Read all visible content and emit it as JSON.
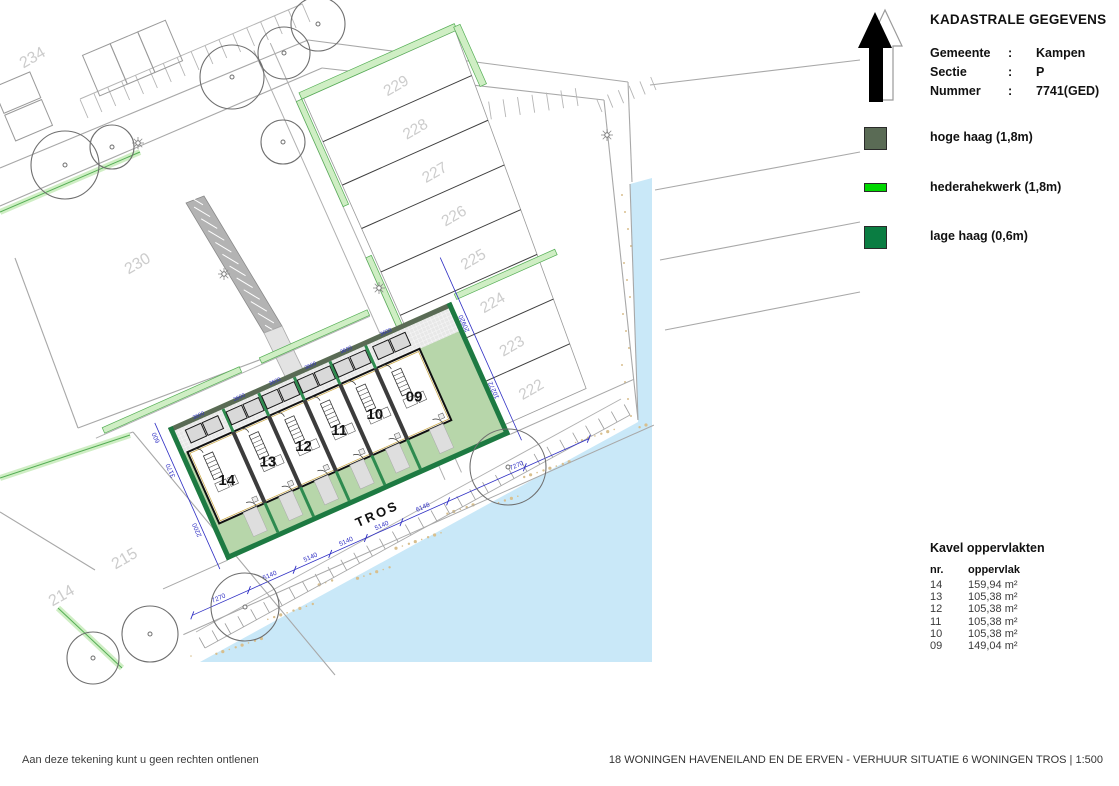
{
  "header": {
    "title": "KADASTRALE GEGEVENS",
    "rows": [
      {
        "label": "Gemeente",
        "sep": ":",
        "value": "Kampen"
      },
      {
        "label": "Sectie",
        "sep": ":",
        "value": "P"
      },
      {
        "label": "Nummer",
        "sep": ":",
        "value": "7741(GED)"
      }
    ]
  },
  "legend": {
    "items": [
      {
        "label": "hoge haag (1,8m)",
        "color": "#5a6b55",
        "h": 23
      },
      {
        "label": "hederahekwerk (1,8m)",
        "color": "#00d800",
        "h": 9
      },
      {
        "label": "lage haag  (0,6m)",
        "color": "#0a7d42",
        "h": 23
      }
    ]
  },
  "kavel": {
    "title": "Kavel oppervlakten",
    "col_nr": "nr.",
    "col_opp": "oppervlak",
    "rows": [
      [
        "14",
        "159,94 m²"
      ],
      [
        "13",
        "105,38 m²"
      ],
      [
        "12",
        "105,38 m²"
      ],
      [
        "11",
        "105,38 m²"
      ],
      [
        "10",
        "105,38 m²"
      ],
      [
        "09",
        "149,04 m²"
      ]
    ]
  },
  "footer": {
    "left": "Aan deze tekening kunt u geen rechten ontlenen",
    "right": "18 WONINGEN HAVENEILAND EN DE ERVEN - VERHUUR SITUATIE 6 WONINGEN TROS  |  1:500"
  },
  "plan": {
    "street": "TROS",
    "houses": [
      "14",
      "13",
      "12",
      "11",
      "10",
      "09"
    ],
    "strip_parcels": [
      "229",
      "228",
      "227",
      "226",
      "225",
      "224",
      "223",
      "222"
    ],
    "other_parcels": [
      [
        "234",
        35,
        62
      ],
      [
        "230",
        140,
        268
      ],
      [
        "215",
        127,
        563
      ],
      [
        "214",
        64,
        600
      ]
    ],
    "dims": {
      "street": [
        "7270",
        "5140",
        "5140",
        "5140",
        "5140",
        "6148",
        "7270"
      ],
      "left_edge": [
        "600",
        "3170",
        "2200"
      ],
      "right_edge": [
        "20920",
        "10272"
      ],
      "back": "3600"
    },
    "trees": [
      [
        65,
        165,
        34
      ],
      [
        112,
        147,
        22
      ],
      [
        232,
        77,
        32
      ],
      [
        284,
        53,
        26
      ],
      [
        318,
        24,
        27
      ],
      [
        283,
        142,
        22
      ],
      [
        150,
        634,
        28
      ],
      [
        245,
        607,
        34
      ],
      [
        508,
        467,
        38
      ],
      [
        93,
        658,
        26
      ]
    ],
    "lamps": [
      [
        138,
        143
      ],
      [
        224,
        274
      ],
      [
        607,
        135
      ],
      [
        379,
        288
      ]
    ],
    "colors": {
      "water": "#c9e8f8",
      "sand": "#d8bf8e",
      "green": "#b7d6aa",
      "hedge_light": "#cfeec4",
      "hedge_light_edge": "#54ae54",
      "hedge_dark": "#1d7a42",
      "hedge_top": "#5a6b55",
      "dim": "#2f2fc4",
      "parcel_text": "#cccccc",
      "line": "#a8a8a8",
      "dark_line": "#3e3e3e"
    }
  }
}
